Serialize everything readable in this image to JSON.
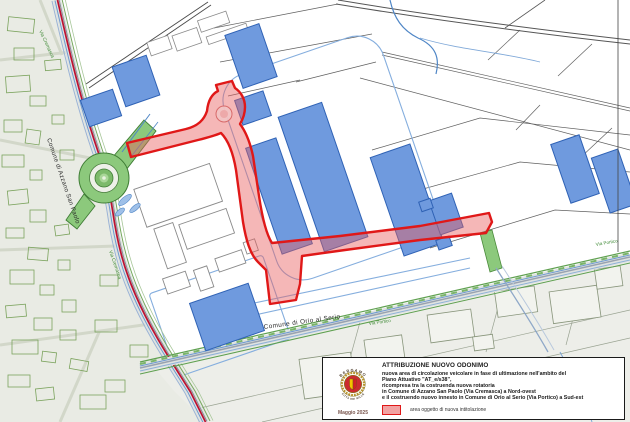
{
  "map": {
    "labels": {
      "municipality_west": "Comune di Azzano San Paolo",
      "municipality_southeast": "Comune di Orio al Serio",
      "street_west": "Via Cremasca",
      "street_west_upper": "Via Cremasca",
      "street_southeast": "Via Portico",
      "street_southeast_far": "Via Portico"
    },
    "colors": {
      "project_area_fill": "#e86060",
      "project_area_border": "#e01818",
      "municipal_boundary_line": "#bd1030",
      "building_fill": "#6f9ade",
      "roundabout_green": "#8cc97c",
      "urban_area_fill": "#e9ebe4"
    }
  },
  "legend": {
    "title": "ATTRIBUZIONE NUOVO ODONIMO",
    "lines": [
      "nuova area di circolazione veicolare in fase di ultimazione nell'ambito del",
      "Piano Attuativo \"AT_e/s38\",",
      "ricompresa tra la costruenda nuova rotatoria",
      "in Comune di Azzano San Paolo (Via Cremasca) a Nord-ovest",
      "e il costruendo nuovo innesto in Comune di Orio al Serio (Via Portico) a Sud-est"
    ],
    "date": "Maggio 2025",
    "swatch_label": "area oggetto di nuova intitolazione",
    "logo": {
      "top": "BERGAMO",
      "bottom": "CITTÀ DEI MILLE"
    }
  }
}
